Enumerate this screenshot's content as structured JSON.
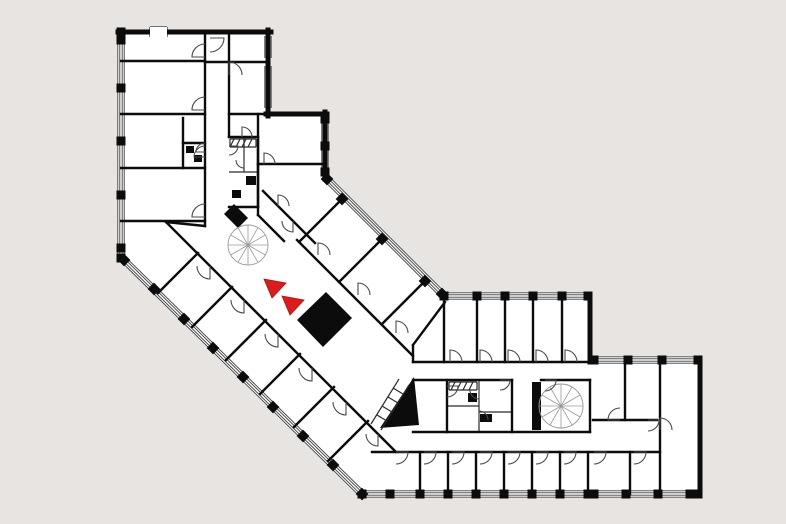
{
  "colors": {
    "background": "#e7e4e1",
    "floor": "#ffffff",
    "wall": "#0c0c0c",
    "thin": "#2a2a2a",
    "stair": "#9a9a9a",
    "marker_red": "#dc1c1c"
  },
  "floorplan": {
    "canvas": {
      "width": 786,
      "height": 524
    },
    "footprint": [
      [
        121,
        30
      ],
      [
        268,
        30
      ],
      [
        268,
        114
      ],
      [
        325,
        114
      ],
      [
        325,
        177
      ],
      [
        444,
        296
      ],
      [
        590,
        296
      ],
      [
        590,
        360
      ],
      [
        700,
        360
      ],
      [
        700,
        494
      ],
      [
        362,
        494
      ],
      [
        124,
        260
      ]
    ],
    "exterior_solid": [
      [
        118,
        32,
        271,
        32
      ],
      [
        268,
        30,
        268,
        116
      ],
      [
        266,
        114,
        327,
        114
      ],
      [
        325,
        112,
        325,
        179
      ],
      [
        590,
        294,
        590,
        362
      ],
      [
        700,
        358,
        700,
        496
      ]
    ],
    "top_wall_notch": {
      "x": 150,
      "y": 27,
      "w": 17,
      "h": 10
    },
    "facades": [
      {
        "name": "west",
        "a": [
          121,
          32
        ],
        "b": [
          121,
          258
        ],
        "piers": [
          [
            121,
            32
          ],
          [
            121,
            40
          ],
          [
            121,
            88
          ],
          [
            121,
            141
          ],
          [
            121,
            195
          ],
          [
            121,
            248
          ],
          [
            121,
            258
          ]
        ]
      },
      {
        "name": "north-block-east-window",
        "a": [
          268,
          36
        ],
        "b": [
          268,
          58
        ],
        "piers": []
      },
      {
        "name": "north-block-east-window2",
        "a": [
          268,
          66
        ],
        "b": [
          268,
          108
        ],
        "piers": []
      },
      {
        "name": "upper-east",
        "a": [
          325,
          119
        ],
        "b": [
          325,
          172
        ],
        "piers": [
          [
            325,
            119
          ],
          [
            325,
            146
          ],
          [
            325,
            172
          ]
        ]
      },
      {
        "name": "diagonal-northeast",
        "a": [
          327,
          179
        ],
        "b": [
          442,
          294
        ],
        "piers": [
          [
            327,
            179
          ],
          [
            342,
            199
          ],
          [
            382,
            239
          ],
          [
            425,
            281
          ],
          [
            442,
            294
          ]
        ]
      },
      {
        "name": "rightwing-north",
        "a": [
          444,
          296
        ],
        "b": [
          588,
          296
        ],
        "piers": [
          [
            444,
            296
          ],
          [
            477,
            296
          ],
          [
            505,
            296
          ],
          [
            533,
            296
          ],
          [
            562,
            296
          ],
          [
            588,
            296
          ]
        ]
      },
      {
        "name": "farright-north",
        "a": [
          592,
          360
        ],
        "b": [
          698,
          360
        ],
        "piers": [
          [
            594,
            360
          ],
          [
            628,
            360
          ],
          [
            662,
            360
          ],
          [
            698,
            360
          ]
        ]
      },
      {
        "name": "farright-south",
        "a": [
          592,
          494
        ],
        "b": [
          698,
          494
        ],
        "piers": [
          [
            594,
            494
          ],
          [
            626,
            494
          ],
          [
            658,
            494
          ],
          [
            690,
            494
          ],
          [
            698,
            494
          ]
        ]
      },
      {
        "name": "rightwing-south",
        "a": [
          362,
          494
        ],
        "b": [
          590,
          494
        ],
        "piers": [
          [
            362,
            494
          ],
          [
            390,
            494
          ],
          [
            420,
            494
          ],
          [
            448,
            494
          ],
          [
            476,
            494
          ],
          [
            504,
            494
          ],
          [
            532,
            494
          ],
          [
            560,
            494
          ],
          [
            588,
            494
          ]
        ]
      },
      {
        "name": "diagonal-southwest",
        "a": [
          124,
          260
        ],
        "b": [
          362,
          494
        ],
        "piers": [
          [
            124,
            260
          ],
          [
            154,
            289
          ],
          [
            184,
            319
          ],
          [
            213,
            348
          ],
          [
            243,
            377
          ],
          [
            273,
            407
          ],
          [
            303,
            436
          ],
          [
            333,
            465
          ],
          [
            362,
            494
          ]
        ]
      }
    ],
    "interior_walls": [
      [
        205,
        32,
        205,
        226
      ],
      [
        166,
        222,
        205,
        226
      ],
      [
        229,
        32,
        229,
        137
      ],
      [
        121,
        61,
        205,
        61
      ],
      [
        121,
        114,
        205,
        114
      ],
      [
        121,
        168,
        205,
        168
      ],
      [
        121,
        221,
        205,
        221
      ],
      [
        183,
        118,
        183,
        168
      ],
      [
        183,
        143,
        205,
        143
      ],
      [
        205,
        62,
        268,
        62
      ],
      [
        229,
        114,
        268,
        114
      ],
      [
        258,
        114,
        258,
        164
      ],
      [
        258,
        164,
        326,
        164
      ],
      [
        258,
        164,
        258,
        215
      ],
      [
        263,
        191,
        315,
        243
      ],
      [
        258,
        215,
        284,
        241
      ],
      [
        297,
        240,
        413,
        356
      ],
      [
        342,
        199,
        299,
        242
      ],
      [
        382,
        239,
        339,
        282
      ],
      [
        425,
        281,
        382,
        324
      ],
      [
        445,
        302,
        413,
        345
      ],
      [
        413,
        345,
        413,
        362
      ],
      [
        444,
        296,
        444,
        362
      ],
      [
        413,
        362,
        590,
        362
      ],
      [
        477,
        298,
        477,
        362
      ],
      [
        505,
        298,
        505,
        362
      ],
      [
        533,
        298,
        533,
        362
      ],
      [
        562,
        298,
        562,
        362
      ],
      [
        166,
        222,
        396,
        452
      ],
      [
        158,
        293,
        198,
        253
      ],
      [
        192,
        327,
        232,
        287
      ],
      [
        226,
        360,
        266,
        320
      ],
      [
        260,
        394,
        300,
        354
      ],
      [
        294,
        427,
        334,
        387
      ],
      [
        328,
        461,
        368,
        421
      ],
      [
        413,
        380,
        512,
        380
      ],
      [
        541,
        380,
        590,
        380
      ],
      [
        447,
        380,
        447,
        432
      ],
      [
        512,
        380,
        512,
        432
      ],
      [
        590,
        380,
        590,
        432
      ],
      [
        413,
        432,
        590,
        432
      ],
      [
        372,
        452,
        660,
        452
      ],
      [
        420,
        452,
        420,
        494
      ],
      [
        448,
        452,
        448,
        494
      ],
      [
        476,
        452,
        476,
        494
      ],
      [
        504,
        452,
        504,
        494
      ],
      [
        532,
        452,
        532,
        494
      ],
      [
        560,
        452,
        560,
        494
      ],
      [
        588,
        452,
        588,
        494
      ],
      [
        630,
        452,
        630,
        494
      ],
      [
        593,
        420,
        657,
        420
      ],
      [
        625,
        362,
        625,
        420
      ],
      [
        660,
        362,
        660,
        494
      ],
      [
        229,
        137,
        258,
        137
      ],
      [
        258,
        137,
        258,
        207
      ],
      [
        229,
        207,
        258,
        207
      ]
    ],
    "thin_walls": [
      [
        244,
        137,
        244,
        172
      ],
      [
        229,
        172,
        258,
        172
      ],
      [
        479,
        380,
        479,
        432
      ],
      [
        447,
        406,
        479,
        406
      ],
      [
        479,
        412,
        512,
        412
      ],
      [
        230,
        139,
        256,
        139
      ],
      [
        256,
        139,
        256,
        147
      ],
      [
        230,
        147,
        256,
        147
      ],
      [
        230,
        139,
        230,
        147
      ],
      [
        234,
        139,
        230,
        147
      ],
      [
        240,
        139,
        236,
        147
      ],
      [
        246,
        139,
        242,
        147
      ],
      [
        252,
        139,
        248,
        147
      ],
      [
        449,
        382,
        477,
        382
      ],
      [
        477,
        382,
        477,
        390
      ],
      [
        449,
        390,
        477,
        390
      ],
      [
        449,
        382,
        449,
        390
      ],
      [
        455,
        382,
        451,
        390
      ],
      [
        461,
        382,
        457,
        390
      ],
      [
        467,
        382,
        463,
        390
      ],
      [
        473,
        382,
        469,
        390
      ],
      [
        371,
        424,
        399,
        379
      ],
      [
        381,
        430,
        409,
        385
      ],
      [
        377,
        415,
        387,
        421
      ],
      [
        382,
        406,
        392,
        412
      ],
      [
        388,
        397,
        398,
        403
      ],
      [
        393,
        388,
        403,
        394
      ],
      [
        150,
        27,
        150,
        37
      ],
      [
        167,
        27,
        167,
        37
      ],
      [
        150,
        27,
        167,
        27
      ]
    ],
    "black_shapes": [
      {
        "name": "elevator-core",
        "points": [
          [
            297,
            320
          ],
          [
            326,
            292
          ],
          [
            352,
            318
          ],
          [
            323,
            347
          ]
        ]
      },
      {
        "name": "shaft-slab",
        "points": [
          [
            224,
            214
          ],
          [
            234,
            204
          ],
          [
            248,
            218
          ],
          [
            238,
            228
          ]
        ]
      },
      {
        "name": "stair-wedge",
        "points": [
          [
            380,
            428
          ],
          [
            414,
            377
          ],
          [
            419,
            425
          ]
        ]
      }
    ],
    "black_rects": [
      [
        532,
        382,
        9,
        48
      ],
      [
        246,
        176,
        10,
        9
      ],
      [
        232,
        190,
        9,
        8
      ],
      [
        468,
        393,
        9,
        9
      ],
      [
        480,
        414,
        12,
        8
      ],
      [
        186,
        146,
        8,
        7
      ],
      [
        194,
        155,
        8,
        7
      ]
    ],
    "spiral_stairs": [
      {
        "name": "spiral-stair-main",
        "cx": 248,
        "cy": 245,
        "r": 20
      },
      {
        "name": "spiral-stair-east",
        "cx": 561,
        "cy": 406,
        "r": 22
      }
    ],
    "doors": [
      [
        205,
        57,
        13,
        180,
        270
      ],
      [
        205,
        110,
        13,
        180,
        270
      ],
      [
        205,
        157,
        11,
        180,
        270
      ],
      [
        205,
        217,
        13,
        180,
        270
      ],
      [
        210,
        38,
        14,
        0,
        90
      ],
      [
        229,
        75,
        13,
        270,
        360
      ],
      [
        242,
        137,
        10,
        270,
        360
      ],
      [
        264,
        164,
        11,
        270,
        360
      ],
      [
        278,
        206,
        11,
        270,
        360
      ],
      [
        293,
        221,
        11,
        90,
        180
      ],
      [
        318,
        255,
        12,
        270,
        360
      ],
      [
        358,
        295,
        12,
        270,
        360
      ],
      [
        396,
        333,
        12,
        270,
        360
      ],
      [
        210,
        266,
        13,
        90,
        180
      ],
      [
        244,
        300,
        13,
        90,
        180
      ],
      [
        278,
        334,
        13,
        90,
        180
      ],
      [
        312,
        368,
        13,
        90,
        180
      ],
      [
        346,
        402,
        13,
        90,
        180
      ],
      [
        378,
        434,
        12,
        90,
        180
      ],
      [
        450,
        362,
        12,
        270,
        360
      ],
      [
        480,
        362,
        12,
        270,
        360
      ],
      [
        508,
        362,
        12,
        270,
        360
      ],
      [
        536,
        362,
        12,
        270,
        360
      ],
      [
        565,
        362,
        12,
        270,
        360
      ],
      [
        447,
        386,
        11,
        0,
        90
      ],
      [
        479,
        390,
        9,
        90,
        180
      ],
      [
        479,
        420,
        9,
        270,
        360
      ],
      [
        500,
        380,
        10,
        0,
        90
      ],
      [
        545,
        380,
        11,
        0,
        90
      ],
      [
        396,
        452,
        12,
        0,
        90
      ],
      [
        424,
        452,
        12,
        0,
        90
      ],
      [
        452,
        452,
        12,
        0,
        90
      ],
      [
        480,
        452,
        12,
        0,
        90
      ],
      [
        508,
        452,
        12,
        0,
        90
      ],
      [
        536,
        452,
        12,
        0,
        90
      ],
      [
        564,
        452,
        12,
        0,
        90
      ],
      [
        594,
        452,
        12,
        0,
        90
      ],
      [
        634,
        452,
        12,
        0,
        90
      ],
      [
        620,
        420,
        12,
        180,
        270
      ],
      [
        648,
        420,
        11,
        0,
        90
      ],
      [
        660,
        430,
        12,
        270,
        360
      ],
      [
        205,
        152,
        9,
        180,
        270
      ],
      [
        229,
        146,
        9,
        0,
        90
      ],
      [
        244,
        160,
        8,
        90,
        180
      ]
    ],
    "markers": [
      {
        "name": "direction-arrow-1",
        "points": [
          [
            264,
            279
          ],
          [
            286,
            283
          ],
          [
            272,
            298
          ]
        ]
      },
      {
        "name": "direction-arrow-2",
        "points": [
          [
            282,
            296
          ],
          [
            304,
            300
          ],
          [
            290,
            315
          ]
        ]
      }
    ]
  }
}
